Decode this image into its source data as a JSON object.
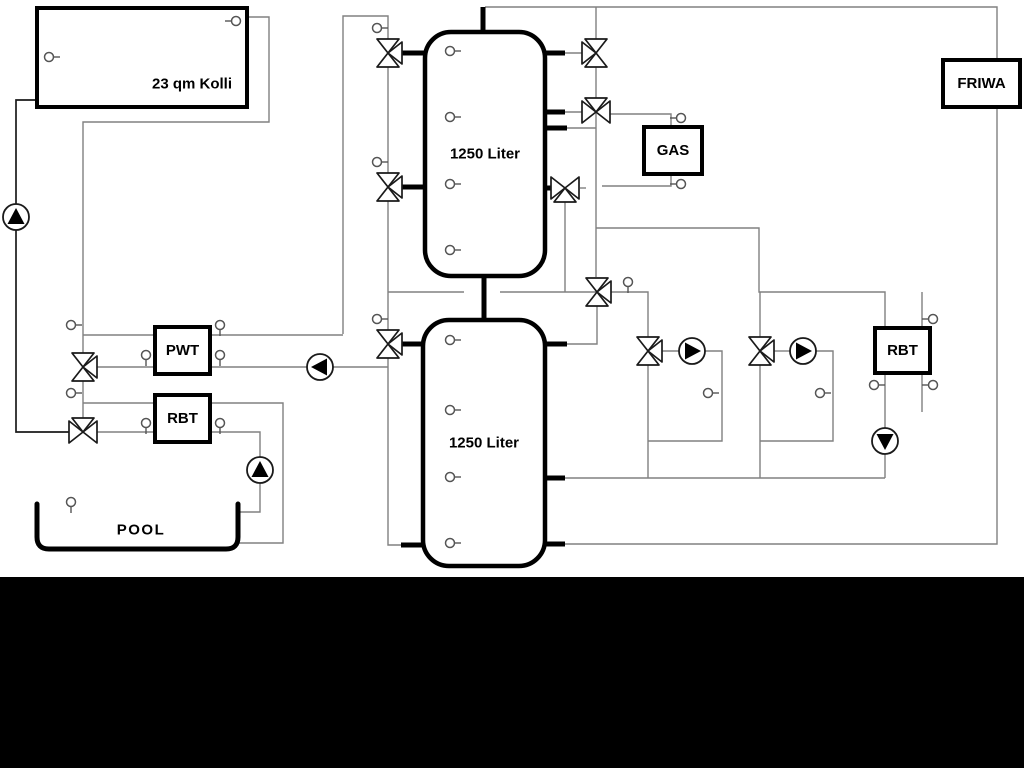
{
  "labels": {
    "collector": "23 qm Kolli",
    "tank_upper": "1250 Liter",
    "tank_lower": "1250 Liter",
    "gas": "GAS",
    "friwa": "FRIWA",
    "pwt": "PWT",
    "rbt_left": "RBT",
    "rbt_right": "RBT",
    "pool": "POOL"
  },
  "colors": {
    "line": "#808080",
    "dark": "#1a1a1a",
    "black": "#000000",
    "fill": "#ffffff",
    "band": "#000000"
  },
  "diagram": {
    "canvas": {
      "w": 1024,
      "h": 768
    },
    "band": {
      "y": 577,
      "h": 191
    },
    "lines": [
      {
        "name": "collector-flow-line",
        "color": "line",
        "pts": [
          [
            247,
            17
          ],
          [
            269,
            17
          ],
          [
            269,
            122
          ],
          [
            83,
            122
          ],
          [
            83,
            432
          ]
        ]
      },
      {
        "name": "collector-return-line",
        "color": "dark",
        "pts": [
          [
            37,
            100
          ],
          [
            16,
            100
          ],
          [
            16,
            432
          ],
          [
            83,
            432
          ]
        ]
      },
      {
        "name": "top-header-friwa-loop",
        "color": "line",
        "pts": [
          [
            485,
            7
          ],
          [
            997,
            7
          ],
          [
            997,
            544
          ],
          [
            565,
            544
          ]
        ]
      },
      {
        "name": "header-drop-line",
        "color": "line",
        "pts": [
          [
            596,
            7
          ],
          [
            596,
            277
          ]
        ]
      },
      {
        "name": "valve4-left-link",
        "color": "line",
        "pts": [
          [
            565,
            112
          ],
          [
            582,
            112
          ]
        ]
      },
      {
        "name": "gas-supply-line",
        "color": "line",
        "pts": [
          [
            610,
            114
          ],
          [
            671,
            114
          ],
          [
            671,
            127
          ]
        ]
      },
      {
        "name": "gas-return-line",
        "color": "line",
        "pts": [
          [
            671,
            174
          ],
          [
            671,
            186
          ],
          [
            602,
            186
          ]
        ]
      },
      {
        "name": "valve5-right-tick",
        "color": "line",
        "pts": [
          [
            580,
            188
          ],
          [
            586,
            188
          ]
        ]
      },
      {
        "name": "tank1-port3-link",
        "color": "line",
        "pts": [
          [
            567,
            128
          ],
          [
            596,
            128
          ]
        ]
      },
      {
        "name": "valve3-left-link",
        "color": "line",
        "pts": [
          [
            565,
            53
          ],
          [
            582,
            53
          ]
        ]
      },
      {
        "name": "solar-riser-line",
        "color": "line",
        "pts": [
          [
            343,
            334
          ],
          [
            343,
            16
          ],
          [
            388,
            16
          ],
          [
            388,
            53
          ]
        ]
      },
      {
        "name": "tank-left-drop-line",
        "color": "line",
        "pts": [
          [
            388,
            67
          ],
          [
            388,
            545
          ],
          [
            401,
            545
          ]
        ]
      },
      {
        "name": "mid-link-left",
        "color": "line",
        "pts": [
          [
            388,
            292
          ],
          [
            464,
            292
          ]
        ]
      },
      {
        "name": "mid-link-right",
        "color": "line",
        "pts": [
          [
            500,
            292
          ],
          [
            597,
            292
          ]
        ]
      },
      {
        "name": "valve5-riser",
        "color": "line",
        "pts": [
          [
            565,
            202
          ],
          [
            565,
            292
          ]
        ]
      },
      {
        "name": "circuit1-supply",
        "color": "line",
        "pts": [
          [
            611,
            292
          ],
          [
            648,
            292
          ],
          [
            648,
            337
          ]
        ]
      },
      {
        "name": "valve9-tank-link",
        "color": "line",
        "pts": [
          [
            597,
            306
          ],
          [
            597,
            344
          ],
          [
            567,
            344
          ]
        ]
      },
      {
        "name": "circuit2-header",
        "color": "line",
        "pts": [
          [
            596,
            228
          ],
          [
            759,
            228
          ],
          [
            759,
            292
          ],
          [
            885,
            292
          ],
          [
            885,
            329
          ]
        ]
      },
      {
        "name": "valve11-riser",
        "color": "line",
        "pts": [
          [
            760,
            292
          ],
          [
            760,
            337
          ]
        ]
      },
      {
        "name": "pump1-inlet",
        "color": "line",
        "pts": [
          [
            662,
            351
          ],
          [
            679,
            351
          ]
        ]
      },
      {
        "name": "pump1-bypass-loop",
        "color": "line",
        "pts": [
          [
            705,
            351
          ],
          [
            722,
            351
          ],
          [
            722,
            441
          ],
          [
            648,
            441
          ]
        ]
      },
      {
        "name": "valve10-drop",
        "color": "line",
        "pts": [
          [
            648,
            365
          ],
          [
            648,
            478
          ]
        ]
      },
      {
        "name": "pump2-inlet",
        "color": "line",
        "pts": [
          [
            774,
            351
          ],
          [
            790,
            351
          ]
        ]
      },
      {
        "name": "pump2-bypass-loop",
        "color": "line",
        "pts": [
          [
            816,
            351
          ],
          [
            833,
            351
          ],
          [
            833,
            441
          ],
          [
            760,
            441
          ]
        ]
      },
      {
        "name": "valve11-drop",
        "color": "line",
        "pts": [
          [
            760,
            365
          ],
          [
            760,
            478
          ]
        ]
      },
      {
        "name": "return-header",
        "color": "line",
        "pts": [
          [
            565,
            478
          ],
          [
            885,
            478
          ]
        ]
      },
      {
        "name": "rbt-right-drop",
        "color": "line",
        "pts": [
          [
            885,
            373
          ],
          [
            885,
            478
          ]
        ]
      },
      {
        "name": "rbt-right-aux-line",
        "color": "line",
        "pts": [
          [
            922,
            292
          ],
          [
            922,
            412
          ]
        ]
      },
      {
        "name": "pwt-top-left-line",
        "color": "line",
        "pts": [
          [
            83,
            335
          ],
          [
            155,
            335
          ]
        ]
      },
      {
        "name": "pwt-top-right-line",
        "color": "line",
        "pts": [
          [
            210,
            335
          ],
          [
            343,
            335
          ]
        ]
      },
      {
        "name": "pwt-bottom-left-line",
        "color": "line",
        "pts": [
          [
            97,
            367
          ],
          [
            155,
            367
          ]
        ]
      },
      {
        "name": "pwt-bottom-right-line",
        "color": "line",
        "pts": [
          [
            210,
            367
          ],
          [
            307,
            367
          ]
        ]
      },
      {
        "name": "pwt-pump-out-line",
        "color": "line",
        "pts": [
          [
            333,
            367
          ],
          [
            388,
            367
          ]
        ]
      },
      {
        "name": "rbt-top-left-line",
        "color": "line",
        "pts": [
          [
            83,
            403
          ],
          [
            155,
            403
          ]
        ]
      },
      {
        "name": "rbt-to-pool-line",
        "color": "line",
        "pts": [
          [
            210,
            403
          ],
          [
            283,
            403
          ],
          [
            283,
            543
          ],
          [
            239,
            543
          ]
        ]
      },
      {
        "name": "rbt-bottom-left-line",
        "color": "line",
        "pts": [
          [
            97,
            432
          ],
          [
            155,
            432
          ]
        ]
      },
      {
        "name": "rbt-bottom-right-line",
        "color": "line",
        "pts": [
          [
            210,
            432
          ],
          [
            260,
            432
          ],
          [
            260,
            457
          ]
        ]
      },
      {
        "name": "pool-pump-out-line",
        "color": "line",
        "pts": [
          [
            260,
            483
          ],
          [
            260,
            512
          ],
          [
            238,
            512
          ]
        ]
      }
    ],
    "stubs": [
      [
        402,
        53,
        425,
        53
      ],
      [
        402,
        187,
        425,
        187
      ],
      [
        545,
        53,
        565,
        53
      ],
      [
        545,
        112,
        565,
        112
      ],
      [
        545,
        128,
        567,
        128
      ],
      [
        545,
        188,
        551,
        188
      ],
      [
        483,
        7,
        483,
        32
      ],
      [
        484,
        276,
        484,
        320
      ],
      [
        402,
        344,
        423,
        344
      ],
      [
        401,
        545,
        423,
        545
      ],
      [
        545,
        344,
        567,
        344
      ],
      [
        545,
        478,
        565,
        478
      ],
      [
        545,
        544,
        565,
        544
      ]
    ],
    "tanks": [
      {
        "name": "buffer-tank-upper",
        "x": 425,
        "y": 32,
        "w": 120,
        "h": 244,
        "label": "tank_upper"
      },
      {
        "name": "buffer-tank-lower",
        "x": 423,
        "y": 320,
        "w": 122,
        "h": 246,
        "label": "tank_lower"
      }
    ],
    "boxes": [
      {
        "name": "solar-collector-box",
        "x": 37,
        "y": 8,
        "w": 210,
        "h": 99,
        "label": "collector",
        "lx": 192,
        "ly": 84
      },
      {
        "name": "pwt-box",
        "x": 155,
        "y": 327,
        "w": 55,
        "h": 47,
        "label": "pwt"
      },
      {
        "name": "rbt-left-box",
        "x": 155,
        "y": 395,
        "w": 55,
        "h": 47,
        "label": "rbt_left"
      },
      {
        "name": "gas-boiler-box",
        "x": 644,
        "y": 127,
        "w": 58,
        "h": 47,
        "label": "gas"
      },
      {
        "name": "rbt-right-box",
        "x": 875,
        "y": 328,
        "w": 55,
        "h": 45,
        "label": "rbt_right"
      },
      {
        "name": "friwa-box",
        "x": 943,
        "y": 60,
        "w": 77,
        "h": 47,
        "label": "friwa"
      }
    ],
    "valves": [
      {
        "name": "valve-tank1-top-left",
        "x": 388,
        "y": 53,
        "axis": "v",
        "branch": "r"
      },
      {
        "name": "valve-tank1-mid-left",
        "x": 388,
        "y": 187,
        "axis": "v",
        "branch": "r"
      },
      {
        "name": "valve-tank1-top-right",
        "x": 596,
        "y": 53,
        "axis": "v",
        "branch": "l"
      },
      {
        "name": "valve-gas-supply",
        "x": 596,
        "y": 112,
        "axis": "h",
        "branch": "t"
      },
      {
        "name": "valve-gas-return",
        "x": 565,
        "y": 188,
        "axis": "h",
        "branch": "b"
      },
      {
        "name": "valve-pwt-left",
        "x": 83,
        "y": 367,
        "axis": "v",
        "branch": "r"
      },
      {
        "name": "valve-rbt-left",
        "x": 83,
        "y": 432,
        "axis": "h",
        "branch": "t"
      },
      {
        "name": "valve-tank2-left",
        "x": 388,
        "y": 344,
        "axis": "v",
        "branch": "r"
      },
      {
        "name": "valve-circuit-header",
        "x": 597,
        "y": 292,
        "axis": "v",
        "branch": "r"
      },
      {
        "name": "valve-circuit1",
        "x": 648,
        "y": 351,
        "axis": "v",
        "branch": "r"
      },
      {
        "name": "valve-circuit2",
        "x": 760,
        "y": 351,
        "axis": "v",
        "branch": "r"
      }
    ],
    "pumps": [
      {
        "name": "solar-pump",
        "x": 16,
        "y": 217,
        "dir": "up"
      },
      {
        "name": "pwt-pump",
        "x": 320,
        "y": 367,
        "dir": "left"
      },
      {
        "name": "pool-pump",
        "x": 260,
        "y": 470,
        "dir": "up"
      },
      {
        "name": "circuit1-pump",
        "x": 692,
        "y": 351,
        "dir": "right"
      },
      {
        "name": "circuit2-pump",
        "x": 803,
        "y": 351,
        "dir": "right"
      },
      {
        "name": "rbt-right-pump",
        "x": 885,
        "y": 441,
        "dir": "down"
      }
    ],
    "sensors": [
      {
        "x": 236,
        "y": 21,
        "dir": "l"
      },
      {
        "x": 49,
        "y": 57,
        "dir": "r"
      },
      {
        "x": 377,
        "y": 28,
        "dir": "r"
      },
      {
        "x": 377,
        "y": 162,
        "dir": "r"
      },
      {
        "x": 71,
        "y": 325,
        "dir": "r"
      },
      {
        "x": 71,
        "y": 393,
        "dir": "r"
      },
      {
        "x": 146,
        "y": 355,
        "dir": "d"
      },
      {
        "x": 220,
        "y": 325,
        "dir": "d"
      },
      {
        "x": 220,
        "y": 355,
        "dir": "d"
      },
      {
        "x": 146,
        "y": 423,
        "dir": "d"
      },
      {
        "x": 220,
        "y": 423,
        "dir": "d"
      },
      {
        "x": 71,
        "y": 502,
        "dir": "d"
      },
      {
        "x": 377,
        "y": 319,
        "dir": "r"
      },
      {
        "x": 628,
        "y": 282,
        "dir": "d"
      },
      {
        "x": 708,
        "y": 393,
        "dir": "r"
      },
      {
        "x": 820,
        "y": 393,
        "dir": "r"
      },
      {
        "x": 933,
        "y": 319,
        "dir": "l"
      },
      {
        "x": 933,
        "y": 385,
        "dir": "l"
      },
      {
        "x": 874,
        "y": 385,
        "dir": "r"
      },
      {
        "x": 681,
        "y": 118,
        "dir": "l"
      },
      {
        "x": 681,
        "y": 184,
        "dir": "l"
      },
      {
        "x": 450,
        "y": 51,
        "dir": "r"
      },
      {
        "x": 450,
        "y": 117,
        "dir": "r"
      },
      {
        "x": 450,
        "y": 184,
        "dir": "r"
      },
      {
        "x": 450,
        "y": 250,
        "dir": "r"
      },
      {
        "x": 450,
        "y": 340,
        "dir": "r"
      },
      {
        "x": 450,
        "y": 410,
        "dir": "r"
      },
      {
        "x": 450,
        "y": 477,
        "dir": "r"
      },
      {
        "x": 450,
        "y": 543,
        "dir": "r"
      }
    ],
    "pool": {
      "name": "pool-basin",
      "path": "M 37,504 L 37,537 Q 37,549 49,549 L 226,549 Q 238,549 238,537 L 238,504",
      "label": "pool",
      "lx": 141,
      "ly": 530
    }
  }
}
